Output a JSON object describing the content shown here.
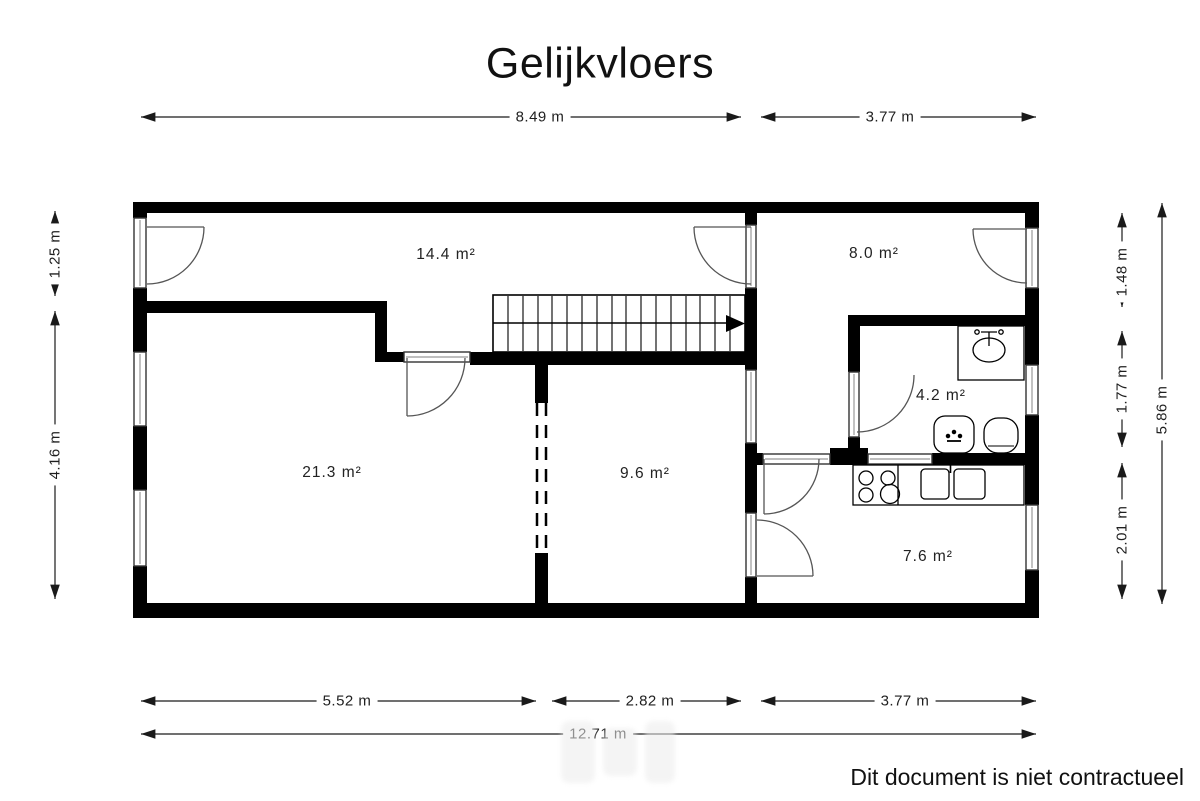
{
  "title": "Gelijkvloers",
  "footer": {
    "disclaimer": "Dit document is niet contractueel"
  },
  "rooms": {
    "top_hall": {
      "area": "14.4 m²"
    },
    "top_right": {
      "area": "8.0 m²"
    },
    "left_room": {
      "area": "21.3 m²"
    },
    "middle_room": {
      "area": "9.6 m²"
    },
    "bathroom": {
      "area": "4.2 m²"
    },
    "kitchen": {
      "area": "7.6 m²"
    }
  },
  "dimensions": {
    "top_left_width": "8.49 m",
    "top_right_width": "3.77 m",
    "left_upper": "1.25 m",
    "left_lower": "4.16 m",
    "right_upper": "1.48 m",
    "right_middle": "1.77 m",
    "right_lower": "2.01 m",
    "right_total": "5.86 m",
    "bottom_left": "5.52 m",
    "bottom_middle": "2.82 m",
    "bottom_right": "3.77 m",
    "bottom_total": "12.71 m"
  },
  "legend_icons": [
    "staircase",
    "stairs-direction-arrow",
    "door-swing",
    "window",
    "washbasin",
    "toilet",
    "bidet",
    "cooktop",
    "double-sink"
  ],
  "colors": {
    "wall": "#000000",
    "background": "#ffffff",
    "dimension_line": "#1a1a1a",
    "door_arc": "#555555"
  }
}
